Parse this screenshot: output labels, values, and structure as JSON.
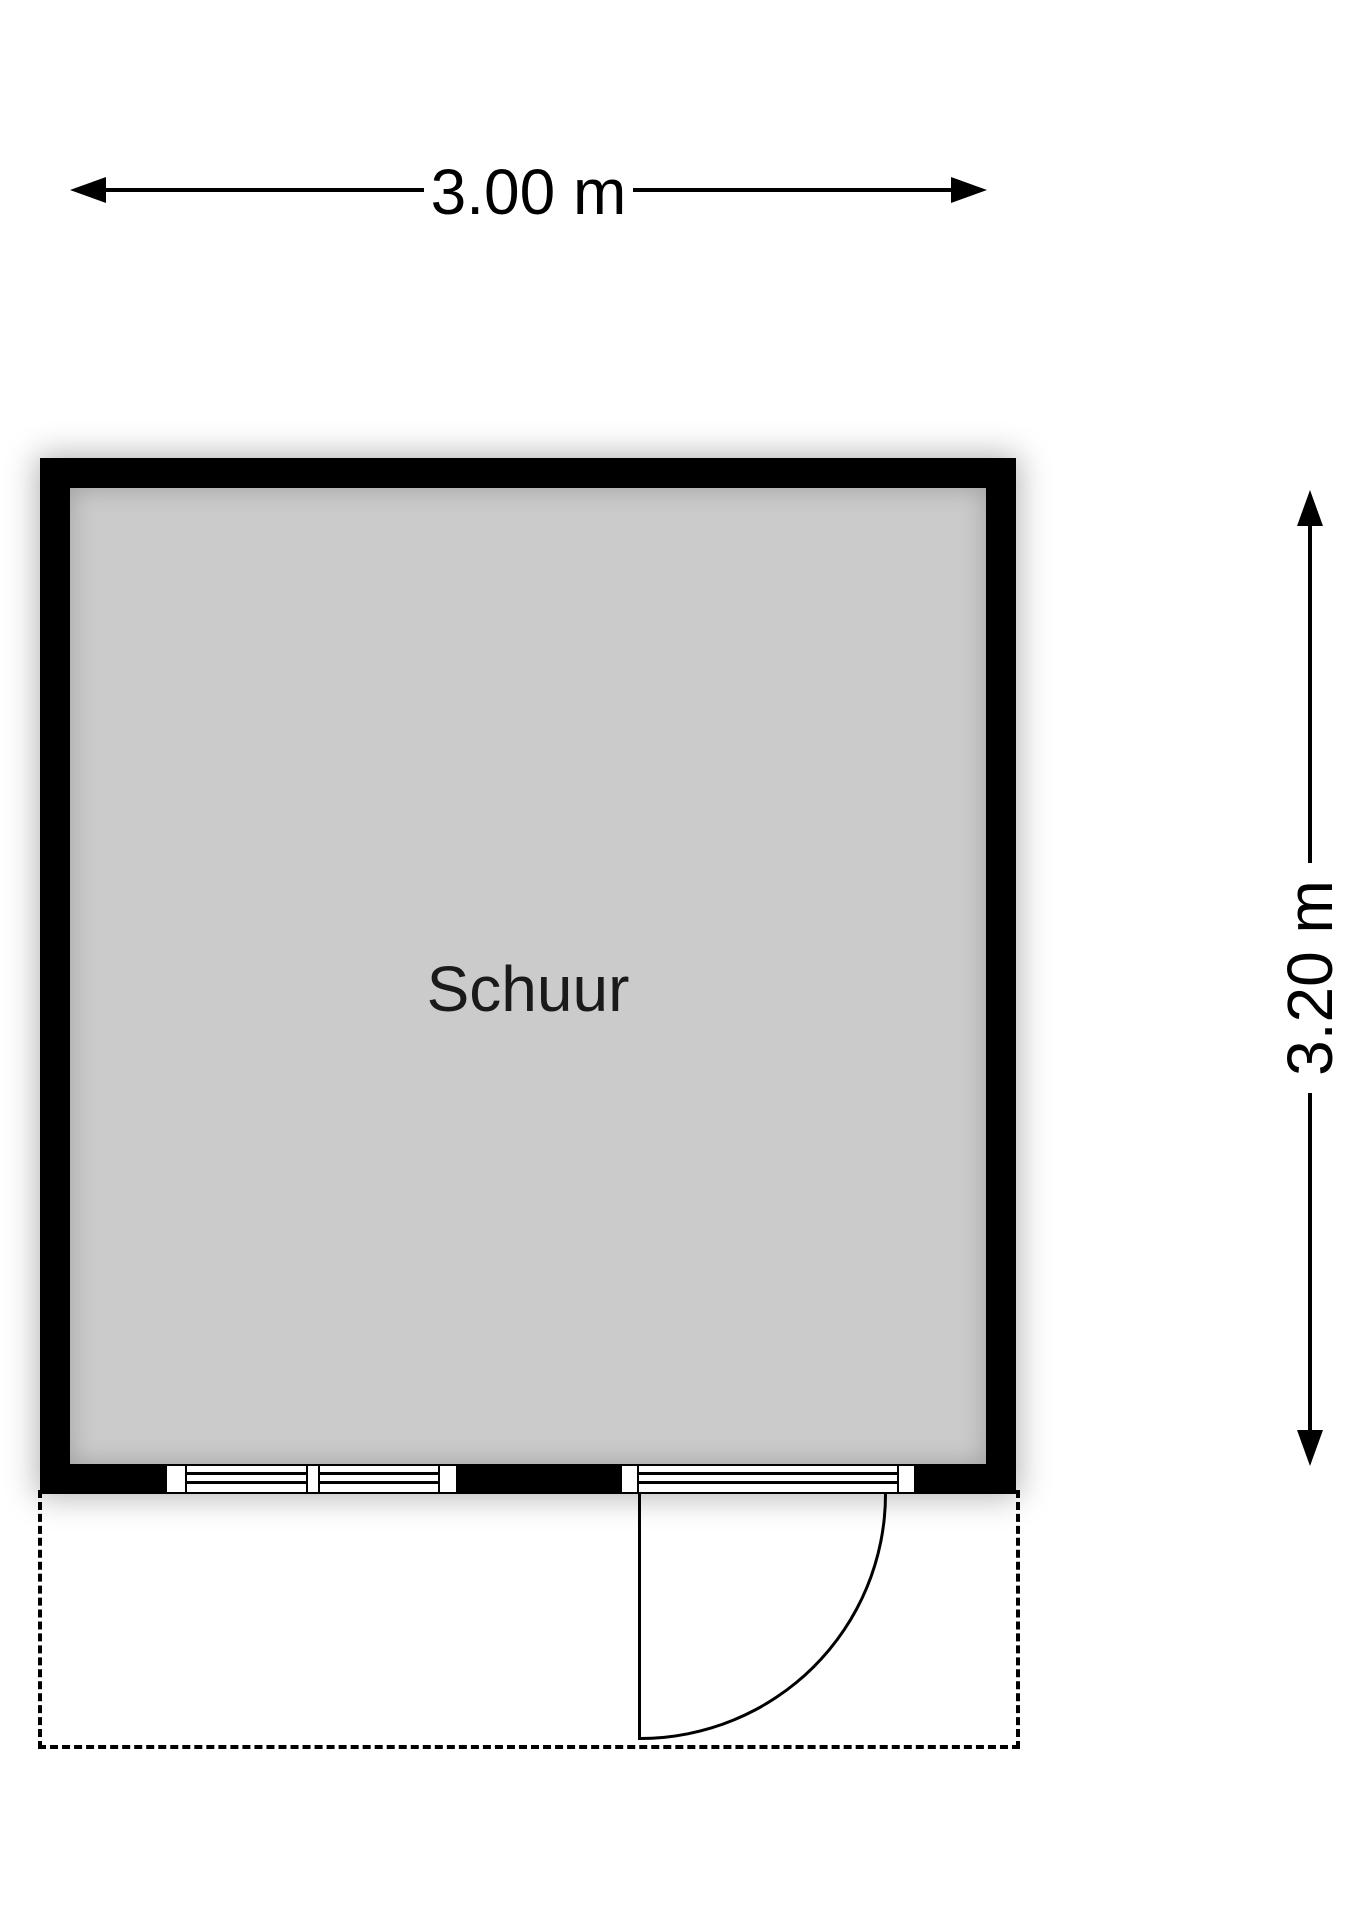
{
  "plan": {
    "room": {
      "label": "Schuur"
    },
    "dimensions": {
      "width_label": "3.00 m",
      "height_label": "3.20 m"
    },
    "features": {
      "window": "double-window-bottom-wall",
      "door": "single-door-bottom-wall-swing-out",
      "overhang": "dashed-outline-area"
    },
    "colors": {
      "wall": "#000000",
      "floor": "#cbcbcb",
      "lines": "#000000",
      "background": "#ffffff"
    }
  }
}
